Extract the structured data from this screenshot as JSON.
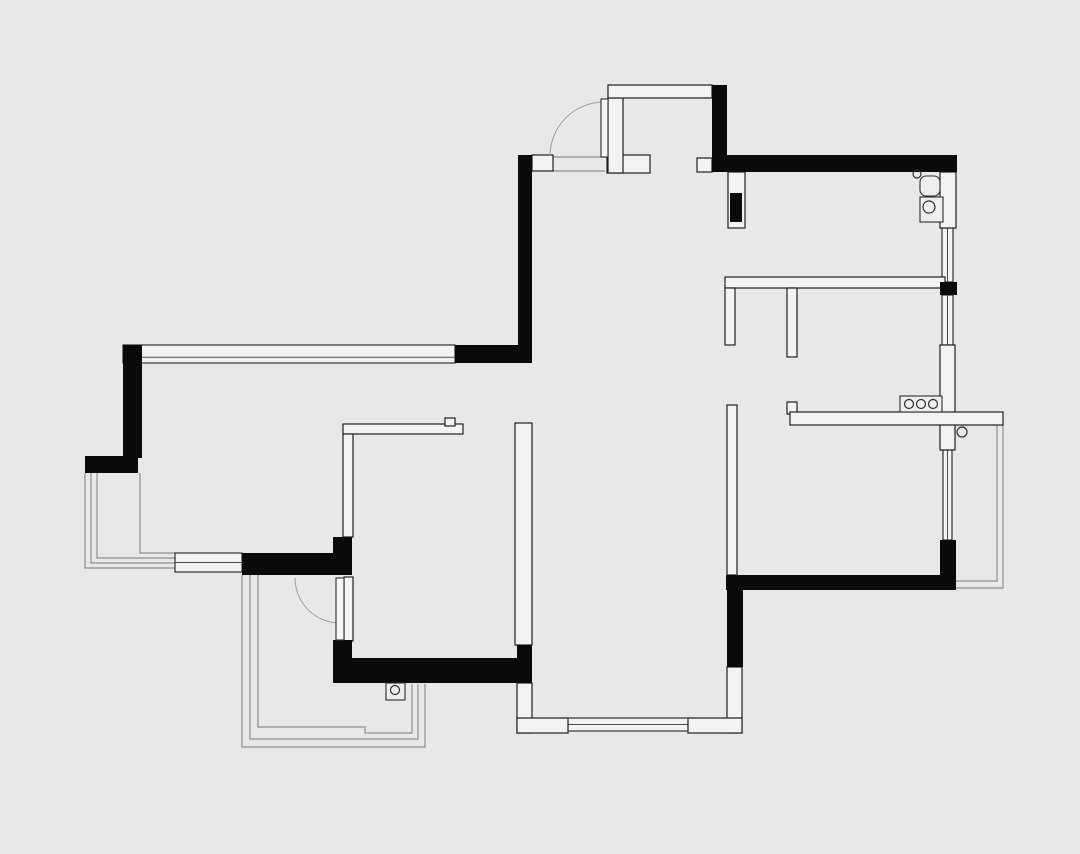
{
  "canvas": {
    "width": 1080,
    "height": 854,
    "background": "#e8e8e8"
  },
  "palette": {
    "structural_wall": "#0a0a0a",
    "partition_wall_fill": "#f3f3f3",
    "wall_outline": "#1f1f1f",
    "railing_line": "#8f8f8f",
    "door_arc": "#9c9c9c"
  },
  "plan": {
    "black_walls": [
      {
        "id": "entry-west-wall",
        "r": [
          518,
          155,
          14,
          208
        ]
      },
      {
        "id": "northwest-wall-corner",
        "r": [
          455,
          345,
          77,
          18
        ]
      },
      {
        "id": "west-exterior-wall",
        "r": [
          123,
          345,
          19,
          113
        ]
      },
      {
        "id": "west-balcony-ledge",
        "r": [
          85,
          456,
          53,
          17
        ]
      },
      {
        "id": "bedroom3-south-wall",
        "r": [
          242,
          553,
          110,
          22
        ]
      },
      {
        "id": "bedroom2-west-wall-upper",
        "r": [
          333,
          537,
          19,
          38
        ]
      },
      {
        "id": "bedroom2-west-wall-lower",
        "r": [
          333,
          640,
          19,
          43
        ]
      },
      {
        "id": "south-wall-band",
        "r": [
          352,
          658,
          165,
          25
        ]
      },
      {
        "id": "south-step-block",
        "r": [
          517,
          645,
          15,
          38
        ]
      },
      {
        "id": "north-exterior-wall",
        "r": [
          712,
          155,
          245,
          17
        ]
      },
      {
        "id": "entry-niche-east-wall",
        "r": [
          712,
          85,
          15,
          70
        ]
      },
      {
        "id": "entry-pier-fill",
        "r": [
          730,
          193,
          12,
          29
        ]
      },
      {
        "id": "east-wall-block",
        "r": [
          940,
          282,
          17,
          13
        ]
      },
      {
        "id": "east-wall-corner",
        "r": [
          940,
          540,
          16,
          50
        ]
      },
      {
        "id": "southeast-wall",
        "r": [
          726,
          575,
          229,
          15
        ]
      },
      {
        "id": "living-east-wall",
        "r": [
          727,
          580,
          16,
          87
        ]
      }
    ],
    "white_walls": [
      {
        "id": "entry-door-left-jamb",
        "r": [
          532,
          155,
          21,
          16
        ]
      },
      {
        "id": "entry-door-right-jamb",
        "r": [
          607,
          155,
          43,
          18
        ]
      },
      {
        "id": "entry-niche-west-wall",
        "r": [
          608,
          98,
          15,
          75
        ]
      },
      {
        "id": "entry-niche-north-wall",
        "r": [
          608,
          85,
          104,
          13
        ]
      },
      {
        "id": "entry-east-stub",
        "r": [
          697,
          158,
          15,
          14
        ]
      },
      {
        "id": "entry-pier",
        "r": [
          728,
          172,
          17,
          56
        ]
      },
      {
        "id": "northeast-column",
        "r": [
          940,
          172,
          16,
          56
        ]
      },
      {
        "id": "east-wall-mid-segment",
        "r": [
          940,
          345,
          15,
          105
        ]
      },
      {
        "id": "closet-wall-horizontal",
        "r": [
          725,
          277,
          220,
          11
        ]
      },
      {
        "id": "closet-wall-leg-a",
        "r": [
          725,
          288,
          10,
          57
        ]
      },
      {
        "id": "closet-wall-leg-b",
        "r": [
          787,
          288,
          10,
          69
        ]
      },
      {
        "id": "kitchen-wall-hook",
        "r": [
          787,
          402,
          10,
          12
        ]
      },
      {
        "id": "kitchen-wall-horizontal",
        "r": [
          790,
          412,
          213,
          13
        ]
      },
      {
        "id": "hall-wall-vertical",
        "r": [
          727,
          405,
          10,
          170
        ]
      },
      {
        "id": "bedroom2-north-wall",
        "r": [
          343,
          424,
          120,
          10
        ]
      },
      {
        "id": "bedroom2-north-notch",
        "r": [
          445,
          418,
          10,
          8
        ]
      },
      {
        "id": "bedroom2-west-partition",
        "r": [
          343,
          434,
          10,
          103
        ]
      },
      {
        "id": "bedroom2-east-wall",
        "r": [
          515,
          423,
          17,
          222
        ]
      },
      {
        "id": "living-southwest-wall-v",
        "r": [
          517,
          683,
          15,
          50
        ]
      },
      {
        "id": "living-southwest-wall-h",
        "r": [
          517,
          718,
          51,
          15
        ]
      },
      {
        "id": "living-southeast-wall-v",
        "r": [
          727,
          667,
          15,
          66
        ]
      },
      {
        "id": "living-southeast-wall-h",
        "r": [
          688,
          718,
          54,
          15
        ]
      },
      {
        "id": "balcony-door-jamb",
        "r": [
          344,
          577,
          9,
          64
        ]
      }
    ],
    "windows": [
      {
        "id": "north-long-window",
        "r": [
          123,
          345,
          332,
          18
        ],
        "o": "h",
        "f": 0.68
      },
      {
        "id": "bedroom3-south-window",
        "r": [
          175,
          553,
          67,
          19
        ],
        "o": "h",
        "f": 0.5
      },
      {
        "id": "living-south-window",
        "r": [
          566,
          718,
          124,
          13
        ],
        "o": "h",
        "f": 0.5
      },
      {
        "id": "east-window-upper",
        "r": [
          942,
          228,
          11,
          54
        ],
        "o": "v",
        "f": 0.5
      },
      {
        "id": "east-window-mid",
        "r": [
          942,
          295,
          11,
          50
        ],
        "o": "v",
        "f": 0.5
      },
      {
        "id": "east-balcony-window",
        "r": [
          943,
          450,
          9,
          90
        ],
        "o": "v",
        "f": 0.5
      }
    ],
    "railings": [
      {
        "id": "west-balcony-rail-outer",
        "pts": [
          [
            85,
            473
          ],
          [
            85,
            568
          ],
          [
            175,
            568
          ]
        ]
      },
      {
        "id": "west-balcony-rail-mid",
        "pts": [
          [
            91,
            473
          ],
          [
            91,
            563
          ],
          [
            175,
            563
          ]
        ]
      },
      {
        "id": "west-balcony-rail-in",
        "pts": [
          [
            97,
            473
          ],
          [
            97,
            558
          ],
          [
            175,
            558
          ]
        ]
      },
      {
        "id": "west-balcony-inner-edge",
        "pts": [
          [
            140,
            473
          ],
          [
            140,
            553
          ],
          [
            175,
            553
          ]
        ]
      },
      {
        "id": "south-balcony-rail-outer",
        "pts": [
          [
            242,
            575
          ],
          [
            242,
            747
          ],
          [
            425,
            747
          ],
          [
            425,
            684
          ]
        ]
      },
      {
        "id": "south-balcony-rail-mid",
        "pts": [
          [
            250,
            575
          ],
          [
            250,
            739
          ],
          [
            418,
            739
          ],
          [
            418,
            684
          ]
        ]
      },
      {
        "id": "south-balcony-rail-inner",
        "pts": [
          [
            258,
            575
          ],
          [
            258,
            727
          ],
          [
            365,
            727
          ],
          [
            365,
            733
          ],
          [
            412,
            733
          ],
          [
            412,
            684
          ]
        ]
      },
      {
        "id": "east-balcony-rail-outer",
        "pts": [
          [
            1003,
            425
          ],
          [
            1003,
            588
          ],
          [
            955,
            588
          ]
        ]
      },
      {
        "id": "east-balcony-rail-inner",
        "pts": [
          [
            997,
            425
          ],
          [
            997,
            581
          ],
          [
            955,
            581
          ]
        ]
      },
      {
        "id": "entry-threshold-a",
        "pts": [
          [
            553,
            157
          ],
          [
            605,
            157
          ]
        ]
      },
      {
        "id": "entry-threshold-b",
        "pts": [
          [
            553,
            171
          ],
          [
            605,
            171
          ]
        ]
      }
    ],
    "doors": [
      {
        "id": "entry-door",
        "leaf": [
          601,
          99,
          7,
          58
        ],
        "arc": {
          "sx": 550,
          "sy": 156,
          "ex": 604,
          "ey": 102,
          "r": 54,
          "sweep": 1
        }
      },
      {
        "id": "bedroom2-balcony-door",
        "leaf": [
          336,
          578,
          8,
          62
        ],
        "arc": {
          "sx": 295,
          "sy": 578,
          "ex": 340,
          "ey": 623,
          "r": 45,
          "sweep": 0
        }
      }
    ],
    "fixtures": [
      {
        "id": "wall-hook-fixture",
        "type": "circle",
        "c": [
          917,
          174
        ],
        "r": 4
      },
      {
        "id": "sink-unit-fixture",
        "type": "round-rect",
        "r": [
          920,
          176,
          20,
          20
        ]
      },
      {
        "id": "appliance-fixture",
        "type": "rect-circle",
        "r": [
          920,
          197,
          23,
          25
        ],
        "c": [
          929,
          207
        ],
        "cr": 6
      },
      {
        "id": "cooktop-fixture",
        "type": "cooktop",
        "r": [
          900,
          396,
          42,
          16
        ],
        "burners": [
          [
            909,
            404
          ],
          [
            921,
            404
          ],
          [
            933,
            404
          ]
        ],
        "br": 4.5
      },
      {
        "id": "east-balcony-drain",
        "type": "circle",
        "c": [
          962,
          432
        ],
        "r": 5
      },
      {
        "id": "south-balcony-drain",
        "type": "rect-circle",
        "r": [
          386,
          683,
          19,
          17
        ],
        "c": [
          395,
          690
        ],
        "cr": 4.5
      }
    ]
  }
}
